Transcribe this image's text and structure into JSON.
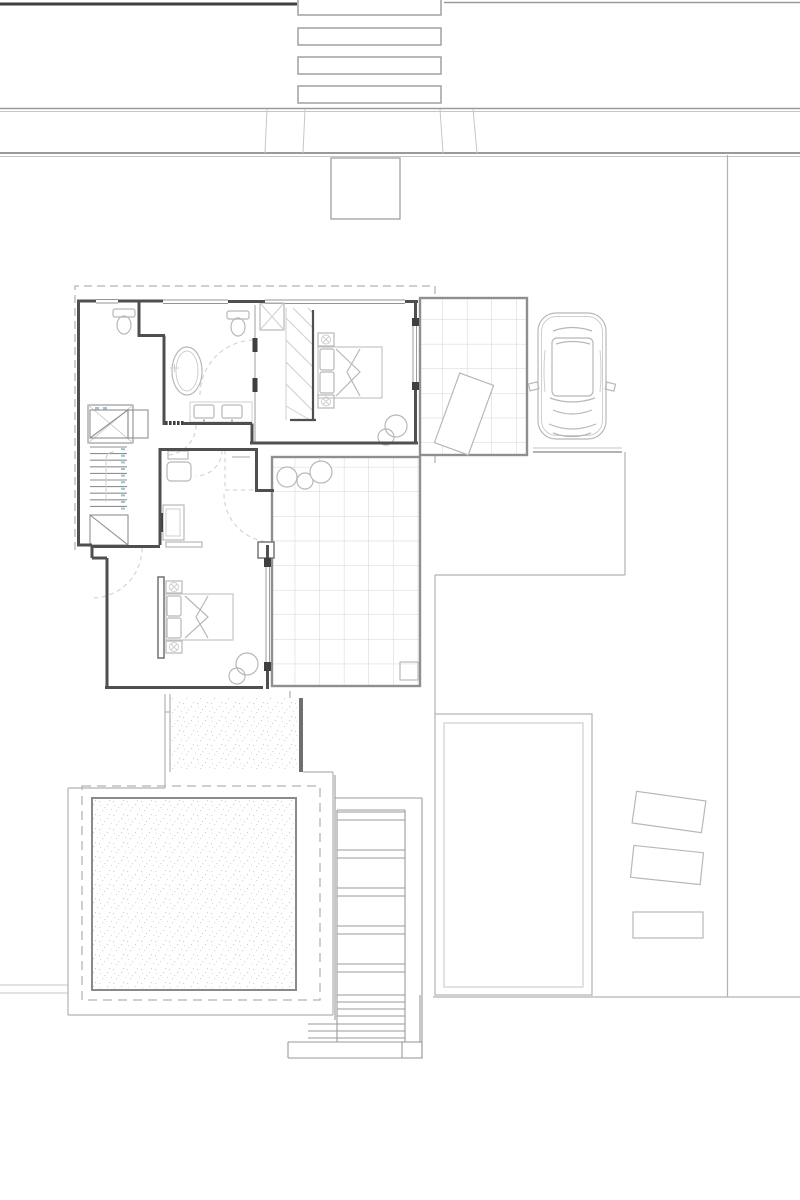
{
  "meta": {
    "document_type": "architectural site / floor plan drawing",
    "view": "top-down plan",
    "visible_text": "none (drawing contains no legible labels or dimensions)",
    "background": "#ffffff"
  },
  "palette": {
    "wall": "#4f4f4f",
    "road_dark": "#3f3f3f",
    "road_mid": "#9a9a9a",
    "boundary": "#b2b2b2",
    "furniture": "#b8b8b8",
    "tile_border": "#8f8f8f",
    "tile_grid": "#d4d4d4",
    "dashed_overhang": "#b5b5b5",
    "stipple": "#d0d0d0",
    "step_mark_teal": "#9cc4cc"
  },
  "labels": {
    "plan": "residential site plan",
    "road": "street with crossing",
    "entry_steps": "street entry steps",
    "entry_pad": "entry landing",
    "house": "house upper floor",
    "bathroom": "bathroom with oval tub, shower, two WCs and double vanity",
    "bedroom_1": "bedroom with double bed and wardrobe",
    "sitting_room": "sitting room with armchair, dresser and TV",
    "master_bedroom": "master bedroom with double bed",
    "stairs": "staircase",
    "patio_ne": "tiled patio with doormat",
    "terrace": "tiled terrace with planting",
    "car": "parked car on driveway",
    "path": "gravel path to pool deck",
    "pool": "swimming pool",
    "pool_deck": "pool deck",
    "garden_steps": "garden terrace steps",
    "lawn": "lawn panel",
    "loungers": "three sun loungers",
    "property": "property boundary"
  }
}
